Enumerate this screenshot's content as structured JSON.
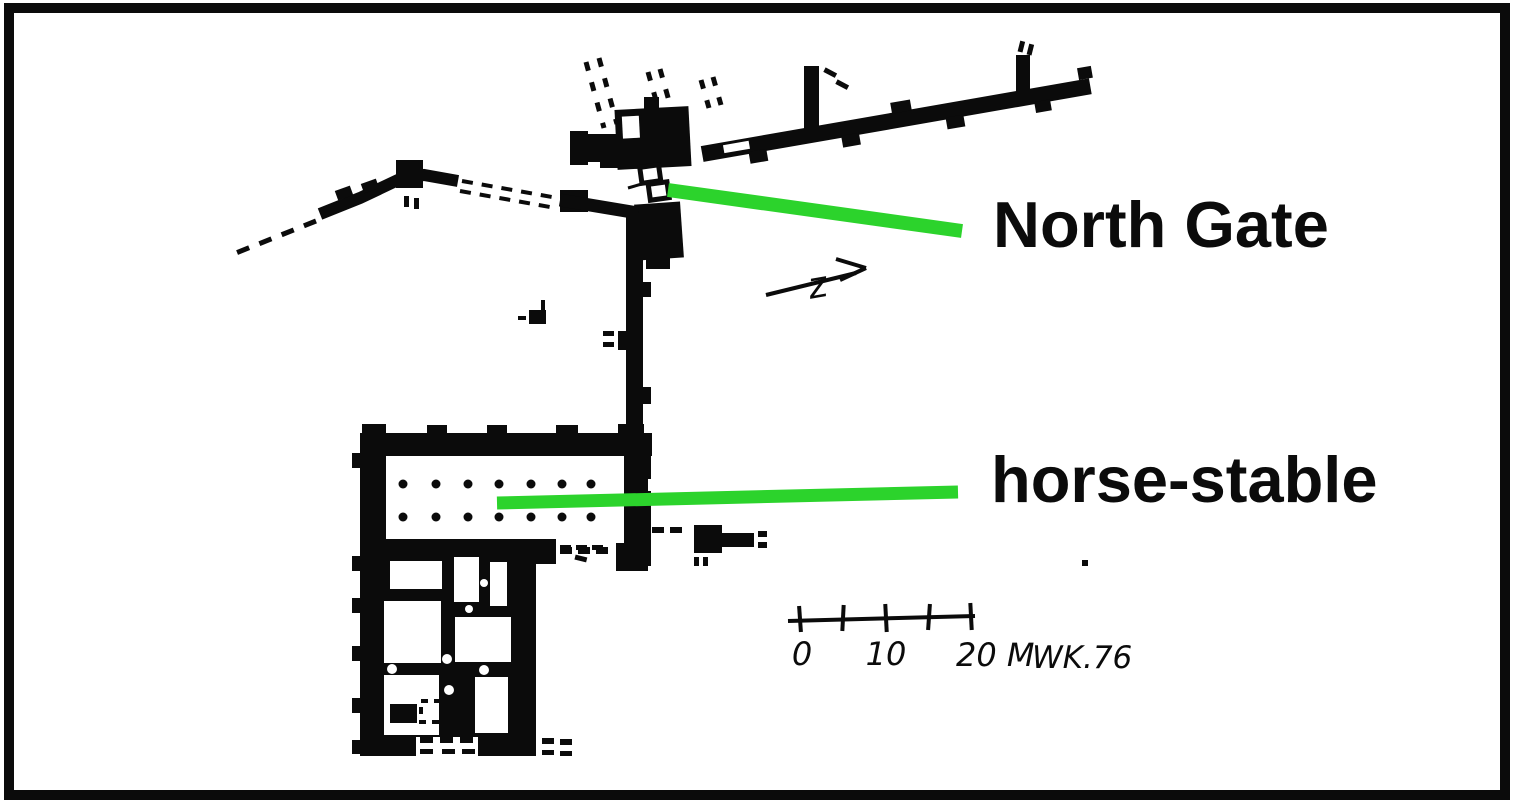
{
  "colors": {
    "ink": "#0b0b0b",
    "annotation_green": "#2cd32c",
    "background": "#ffffff"
  },
  "callouts": [
    {
      "label": "North Gate"
    },
    {
      "label": "horse-stable"
    }
  ],
  "scale_bar": {
    "zero_label": "0",
    "ten_label": "10",
    "twenty_label": "20 M",
    "credit": "WK.76"
  },
  "north_arrow": {
    "glyph": "z"
  }
}
